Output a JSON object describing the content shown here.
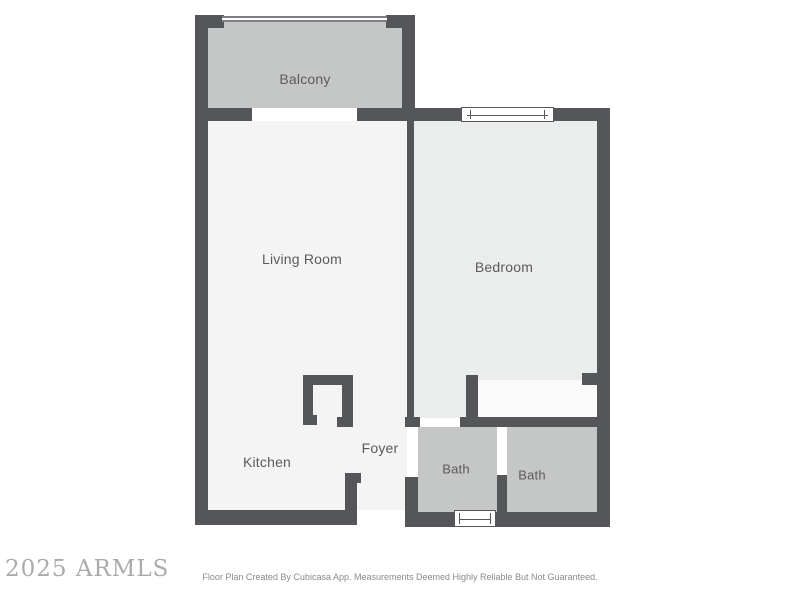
{
  "plan": {
    "rooms": [
      {
        "id": "balcony",
        "label": "Balcony"
      },
      {
        "id": "living-room",
        "label": "Living Room"
      },
      {
        "id": "bedroom",
        "label": "Bedroom"
      },
      {
        "id": "kitchen",
        "label": "Kitchen"
      },
      {
        "id": "foyer",
        "label": "Foyer"
      },
      {
        "id": "bath-1",
        "label": "Bath"
      },
      {
        "id": "bath-2",
        "label": "Bath"
      }
    ],
    "features": [
      {
        "id": "balcony-railing",
        "type": "railing"
      },
      {
        "id": "balcony-door-opening",
        "type": "opening"
      },
      {
        "id": "bedroom-window",
        "type": "window"
      },
      {
        "id": "bath-window",
        "type": "window"
      },
      {
        "id": "entry-opening",
        "type": "opening"
      },
      {
        "id": "bedroom-closet",
        "type": "closet"
      }
    ],
    "colors": {
      "wall": "#54565A",
      "floor_light": "#F4F4F4",
      "floor_bedroom": "#EBECEC",
      "floor_gray": "#C5C6C6",
      "floor_closet": "#FAFAFA",
      "label": "#5B5B5B"
    }
  },
  "watermark": {
    "text": "2025 ARMLS"
  },
  "footer": {
    "text": "Floor Plan Created By Cubicasa App. Measurements Deemed Highly Reliable But Not Guaranteed."
  }
}
